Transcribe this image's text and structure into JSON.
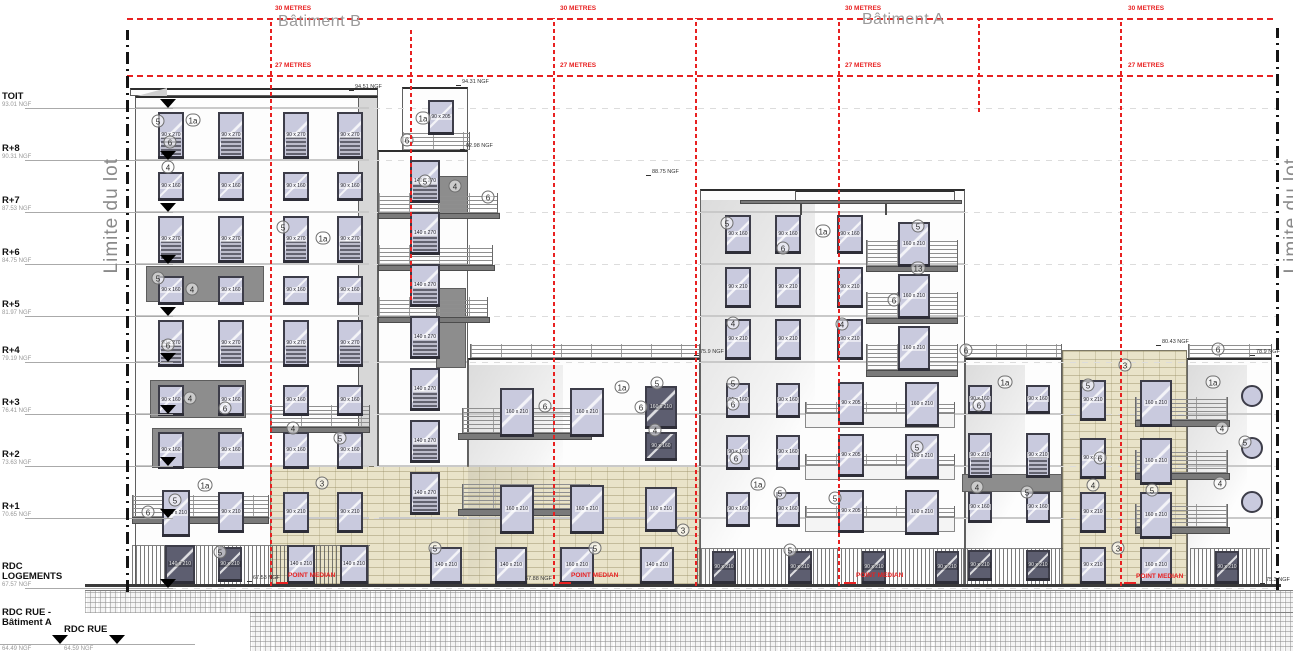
{
  "titles": {
    "batiment_b": "Bâtiment B",
    "batiment_a": "Bâtiment A"
  },
  "drawing": {
    "red": "#e82121",
    "hlines": [
      [
        18,
        127,
        1277
      ],
      [
        75,
        127,
        1277
      ]
    ],
    "red_labels": [
      {
        "text": "30 METRES",
        "y": 5,
        "xs": [
          275,
          560,
          845,
          1128
        ]
      },
      {
        "text": "27 METRES",
        "y": 62,
        "xs": [
          275,
          560,
          845,
          1128
        ]
      }
    ],
    "vlines": [
      [
        270,
        18,
        586
      ],
      [
        410,
        28,
        300
      ],
      [
        553,
        18,
        586
      ],
      [
        695,
        18,
        586
      ],
      [
        838,
        18,
        586
      ],
      [
        978,
        18,
        112
      ],
      [
        1120,
        18,
        586
      ]
    ],
    "point_median": {
      "text": "POINT MEDIAN",
      "points": [
        [
          282,
          572
        ],
        [
          565,
          572
        ],
        [
          850,
          572
        ],
        [
          1130,
          573
        ]
      ]
    },
    "limits": {
      "text": "Limite du lot",
      "lines": [
        [
          127,
          30,
          592
        ],
        [
          1277,
          28,
          590
        ]
      ],
      "texts": [
        [
          101,
          158
        ],
        [
          1281,
          158
        ]
      ]
    },
    "levels": [
      [
        "TOIT",
        "93.01 NGF",
        108
      ],
      [
        "R+8",
        "90.31 NGF",
        160
      ],
      [
        "R+7",
        "87.53 NGF",
        212
      ],
      [
        "R+6",
        "84.75 NGF",
        264
      ],
      [
        "R+5",
        "81.97 NGF",
        316
      ],
      [
        "R+4",
        "79.19 NGF",
        362
      ],
      [
        "R+3",
        "76.41 NGF",
        414
      ],
      [
        "R+2",
        "73.63 NGF",
        466
      ],
      [
        "R+1",
        "70.65 NGF",
        518
      ],
      [
        "RDC\nLOGEMENTS",
        "67.57 NGF",
        588
      ]
    ],
    "street_levels": [
      [
        "RDC RUE -\nBâtiment A",
        "64.49 NGF",
        2,
        608,
        60
      ],
      [
        "RDC RUE",
        "64.59 NGF",
        64,
        625,
        117
      ]
    ],
    "street_line": [
      0,
      644,
      195
    ],
    "blocks": [
      [
        130,
        88,
        248,
        8,
        "white",
        0
      ],
      [
        135,
        96,
        235,
        489,
        "white",
        1
      ],
      [
        358,
        96,
        20,
        489,
        "gray",
        0
      ],
      [
        402,
        87,
        66,
        63,
        "white",
        0
      ],
      [
        378,
        150,
        90,
        435,
        "white",
        1
      ],
      [
        468,
        358,
        232,
        227,
        "white",
        1
      ],
      [
        700,
        189,
        265,
        396,
        "white",
        1
      ],
      [
        965,
        358,
        97,
        227,
        "white",
        1
      ],
      [
        1187,
        358,
        85,
        227,
        "white",
        1
      ],
      [
        1062,
        350,
        125,
        235,
        "beige",
        0
      ],
      [
        270,
        466,
        430,
        119,
        "beige",
        0
      ],
      [
        795,
        190,
        160,
        12,
        "white",
        0
      ]
    ],
    "shadows": [
      [
        700,
        200,
        115,
        385
      ],
      [
        468,
        365,
        95,
        215
      ],
      [
        1187,
        365,
        60,
        215
      ],
      [
        965,
        365,
        60,
        215
      ]
    ],
    "panels": [
      [
        146,
        266,
        118,
        36
      ],
      [
        150,
        380,
        96,
        38
      ],
      [
        152,
        428,
        90,
        40
      ],
      [
        438,
        176,
        30,
        42
      ],
      [
        436,
        288,
        30,
        80
      ],
      [
        962,
        474,
        100,
        18
      ]
    ],
    "slabs": [
      [
        378,
        213,
        122,
        6
      ],
      [
        378,
        265,
        117,
        6
      ],
      [
        378,
        317,
        112,
        6
      ],
      [
        270,
        427,
        100,
        6
      ],
      [
        132,
        517,
        137,
        7
      ],
      [
        458,
        433,
        134,
        7
      ],
      [
        458,
        509,
        134,
        7
      ],
      [
        866,
        266,
        92,
        6
      ],
      [
        866,
        318,
        92,
        6
      ],
      [
        866,
        370,
        92,
        7
      ],
      [
        1135,
        420,
        95,
        7
      ],
      [
        1135,
        473,
        95,
        7
      ],
      [
        1135,
        527,
        95,
        7
      ],
      [
        740,
        200,
        222,
        4
      ],
      [
        800,
        204,
        2,
        11
      ],
      [
        885,
        204,
        2,
        11
      ]
    ],
    "bands": [
      [
        805,
        413,
        150,
        15
      ],
      [
        805,
        465,
        150,
        15
      ],
      [
        805,
        517,
        150,
        15
      ]
    ],
    "railings": [
      [
        402,
        132,
        68,
        18
      ],
      [
        378,
        193,
        120,
        20
      ],
      [
        378,
        245,
        115,
        20
      ],
      [
        378,
        297,
        110,
        20
      ],
      [
        270,
        405,
        100,
        22
      ],
      [
        132,
        495,
        137,
        22
      ],
      [
        462,
        408,
        128,
        25
      ],
      [
        462,
        484,
        128,
        25
      ],
      [
        470,
        344,
        230,
        14
      ],
      [
        965,
        344,
        97,
        14
      ],
      [
        1188,
        344,
        84,
        14
      ],
      [
        866,
        240,
        92,
        26
      ],
      [
        866,
        292,
        92,
        26
      ],
      [
        866,
        344,
        92,
        26
      ],
      [
        805,
        402,
        150,
        11
      ],
      [
        805,
        454,
        150,
        11
      ],
      [
        805,
        506,
        150,
        11
      ],
      [
        1135,
        397,
        93,
        23
      ],
      [
        1135,
        450,
        93,
        23
      ],
      [
        1135,
        504,
        93,
        23
      ]
    ],
    "fences": [
      [
        132,
        545,
        238,
        38
      ],
      [
        697,
        548,
        266,
        35
      ],
      [
        963,
        548,
        100,
        35
      ],
      [
        1190,
        548,
        80,
        35
      ]
    ],
    "window_grids": [
      {
        "cols": [
          158,
          218,
          283,
          337
        ],
        "rows": [
          112,
          216,
          320
        ],
        "w": 26,
        "h": 46,
        "label": "90 x 270",
        "v": "striped"
      },
      {
        "cols": [
          158,
          218,
          283,
          337
        ],
        "rows": [
          172,
          276
        ],
        "w": 26,
        "h": 28,
        "label": "90 x 160",
        "v": ""
      },
      {
        "cols": [
          158,
          218,
          283,
          337
        ],
        "rows": [
          385
        ],
        "w": 26,
        "h": 30,
        "label": "90 x 160",
        "v": ""
      },
      {
        "cols": [
          158,
          218,
          283,
          337
        ],
        "rows": [
          432
        ],
        "w": 26,
        "h": 36,
        "label": "90 x 160",
        "v": ""
      },
      {
        "cols": [
          410
        ],
        "rows": [
          160,
          212,
          264,
          316,
          368,
          420,
          472
        ],
        "w": 30,
        "h": 42,
        "label": "140 x 270",
        "v": "striped"
      },
      {
        "cols": [
          500,
          570
        ],
        "rows": [
          388,
          485
        ],
        "w": 34,
        "h": 48,
        "label": "160 x 210",
        "v": ""
      },
      {
        "cols": [
          725,
          775,
          837
        ],
        "rows": [
          215
        ],
        "w": 26,
        "h": 38,
        "label": "90 x 160",
        "v": ""
      },
      {
        "cols": [
          725,
          775,
          837
        ],
        "rows": [
          267,
          319
        ],
        "w": 26,
        "h": 40,
        "label": "90 x 210",
        "v": ""
      },
      {
        "cols": [
          898
        ],
        "rows": [
          222,
          274,
          326
        ],
        "w": 32,
        "h": 44,
        "label": "160 x 210",
        "v": ""
      },
      {
        "cols": [
          726,
          776
        ],
        "rows": [
          383,
          435,
          492
        ],
        "w": 24,
        "h": 34,
        "label": "90 x 160",
        "v": ""
      },
      {
        "cols": [
          838
        ],
        "rows": [
          382,
          434,
          490
        ],
        "w": 26,
        "h": 42,
        "label": "90 x 205",
        "v": ""
      },
      {
        "cols": [
          905
        ],
        "rows": [
          382,
          434,
          490
        ],
        "w": 34,
        "h": 44,
        "label": "160 x 210",
        "v": ""
      },
      {
        "cols": [
          968,
          1026
        ],
        "rows": [
          385
        ],
        "w": 24,
        "h": 28,
        "label": "90 x 160",
        "v": ""
      },
      {
        "cols": [
          968,
          1026
        ],
        "rows": [
          433
        ],
        "w": 24,
        "h": 44,
        "label": "90 x 210",
        "v": "striped"
      },
      {
        "cols": [
          968,
          1026
        ],
        "rows": [
          492
        ],
        "w": 24,
        "h": 30,
        "label": "90 x 160",
        "v": ""
      },
      {
        "cols": [
          1080
        ],
        "rows": [
          380,
          438,
          492
        ],
        "w": 26,
        "h": 40,
        "label": "90 x 210",
        "v": ""
      },
      {
        "cols": [
          1140
        ],
        "rows": [
          380,
          438,
          492
        ],
        "w": 32,
        "h": 46,
        "label": "160 x 210",
        "v": ""
      }
    ],
    "windows_extra": [
      [
        428,
        100,
        26,
        34,
        "90 x 205",
        ""
      ],
      [
        162,
        490,
        28,
        46,
        "140 x 210",
        ""
      ],
      [
        218,
        492,
        26,
        40,
        "90 x 210",
        ""
      ],
      [
        283,
        492,
        26,
        40,
        "90 x 210",
        ""
      ],
      [
        337,
        492,
        26,
        40,
        "90 x 210",
        ""
      ],
      [
        165,
        545,
        30,
        38,
        "140 x 210",
        "dark"
      ],
      [
        218,
        547,
        24,
        34,
        "90 x 210",
        "dark"
      ],
      [
        287,
        545,
        28,
        38,
        "140 x 210",
        ""
      ],
      [
        340,
        545,
        28,
        38,
        "140 x 210",
        ""
      ],
      [
        645,
        386,
        32,
        42,
        "160 x 210",
        "dark"
      ],
      [
        645,
        432,
        32,
        28,
        "90 x 160",
        "dark"
      ],
      [
        645,
        487,
        32,
        44,
        "160 x 210",
        ""
      ],
      [
        430,
        547,
        32,
        36,
        "140 x 210",
        ""
      ],
      [
        495,
        547,
        32,
        36,
        "140 x 210",
        ""
      ],
      [
        560,
        547,
        34,
        36,
        "160 x 210",
        ""
      ],
      [
        640,
        547,
        34,
        36,
        "140 x 210",
        ""
      ],
      [
        712,
        551,
        24,
        32,
        "90 x 210",
        "dark"
      ],
      [
        788,
        551,
        24,
        32,
        "90 x 210",
        "dark"
      ],
      [
        862,
        551,
        24,
        32,
        "90 x 210",
        "dark"
      ],
      [
        935,
        551,
        24,
        32,
        "90 x 210",
        "dark"
      ],
      [
        968,
        550,
        24,
        30,
        "90 x 210",
        "dark"
      ],
      [
        1026,
        550,
        24,
        30,
        "90 x 210",
        "dark"
      ],
      [
        1080,
        547,
        26,
        36,
        "90 x 210",
        ""
      ],
      [
        1140,
        547,
        32,
        36,
        "160 x 210",
        ""
      ],
      [
        1215,
        551,
        24,
        32,
        "90 x 210",
        "dark"
      ]
    ],
    "portholes": [
      [
        1252,
        396
      ],
      [
        1252,
        448
      ],
      [
        1252,
        502
      ]
    ],
    "bubbles": [
      [
        158,
        121,
        "5"
      ],
      [
        193,
        120,
        "1a"
      ],
      [
        170,
        142,
        "6"
      ],
      [
        168,
        167,
        "4"
      ],
      [
        283,
        227,
        "5"
      ],
      [
        323,
        238,
        "1a"
      ],
      [
        158,
        278,
        "5"
      ],
      [
        192,
        289,
        "4"
      ],
      [
        168,
        345,
        "6"
      ],
      [
        190,
        398,
        "4"
      ],
      [
        225,
        408,
        "6"
      ],
      [
        293,
        428,
        "4"
      ],
      [
        340,
        438,
        "5"
      ],
      [
        205,
        485,
        "1a"
      ],
      [
        175,
        500,
        "5"
      ],
      [
        148,
        512,
        "6"
      ],
      [
        220,
        552,
        "5"
      ],
      [
        322,
        483,
        "3"
      ],
      [
        435,
        548,
        "5"
      ],
      [
        423,
        118,
        "1a"
      ],
      [
        407,
        140,
        "6"
      ],
      [
        425,
        181,
        "5"
      ],
      [
        455,
        186,
        "4"
      ],
      [
        488,
        197,
        "6"
      ],
      [
        545,
        406,
        "6"
      ],
      [
        622,
        387,
        "1a"
      ],
      [
        657,
        383,
        "5"
      ],
      [
        641,
        407,
        "6"
      ],
      [
        655,
        430,
        "4"
      ],
      [
        683,
        530,
        "3"
      ],
      [
        595,
        548,
        "5"
      ],
      [
        727,
        223,
        "5"
      ],
      [
        783,
        248,
        "6"
      ],
      [
        823,
        231,
        "1a"
      ],
      [
        918,
        226,
        "5"
      ],
      [
        918,
        268,
        "13"
      ],
      [
        894,
        300,
        "6"
      ],
      [
        733,
        323,
        "4"
      ],
      [
        842,
        324,
        "4"
      ],
      [
        966,
        350,
        "6"
      ],
      [
        733,
        383,
        "5"
      ],
      [
        733,
        404,
        "6"
      ],
      [
        736,
        458,
        "6"
      ],
      [
        758,
        484,
        "1a"
      ],
      [
        780,
        493,
        "5"
      ],
      [
        917,
        447,
        "5"
      ],
      [
        835,
        498,
        "5"
      ],
      [
        790,
        550,
        "5"
      ],
      [
        1005,
        382,
        "1a"
      ],
      [
        979,
        405,
        "6"
      ],
      [
        977,
        487,
        "4"
      ],
      [
        1027,
        492,
        "5"
      ],
      [
        1125,
        365,
        "3"
      ],
      [
        1088,
        385,
        "5"
      ],
      [
        1100,
        458,
        "6"
      ],
      [
        1093,
        485,
        "4"
      ],
      [
        1152,
        490,
        "5"
      ],
      [
        1118,
        548,
        "3"
      ],
      [
        1218,
        349,
        "6"
      ],
      [
        1213,
        382,
        "1a"
      ],
      [
        1222,
        428,
        "4"
      ],
      [
        1245,
        442,
        "5"
      ],
      [
        1220,
        483,
        "4"
      ]
    ],
    "tags": [
      [
        355,
        84,
        "94.51 NGF"
      ],
      [
        462,
        79,
        "94.31 NGF"
      ],
      [
        466,
        143,
        "92.98 NGF"
      ],
      [
        652,
        169,
        "88.75 NGF"
      ],
      [
        700,
        349,
        "75.9 NGF"
      ],
      [
        1162,
        339,
        "80.43 NGF"
      ],
      [
        1256,
        349,
        "78.9 NGF"
      ],
      [
        253,
        575,
        "67.53 NGF"
      ],
      [
        525,
        576,
        "67.88 NGF"
      ],
      [
        1266,
        577,
        "75.3 NGF"
      ]
    ],
    "ground": {
      "baseline": [
        85,
        584,
        1196,
        3
      ],
      "hatches": [
        [
          85,
          590,
          1208,
          22
        ],
        [
          250,
          612,
          1043,
          39
        ]
      ]
    },
    "roof_tri": [
      137,
      88
    ]
  }
}
